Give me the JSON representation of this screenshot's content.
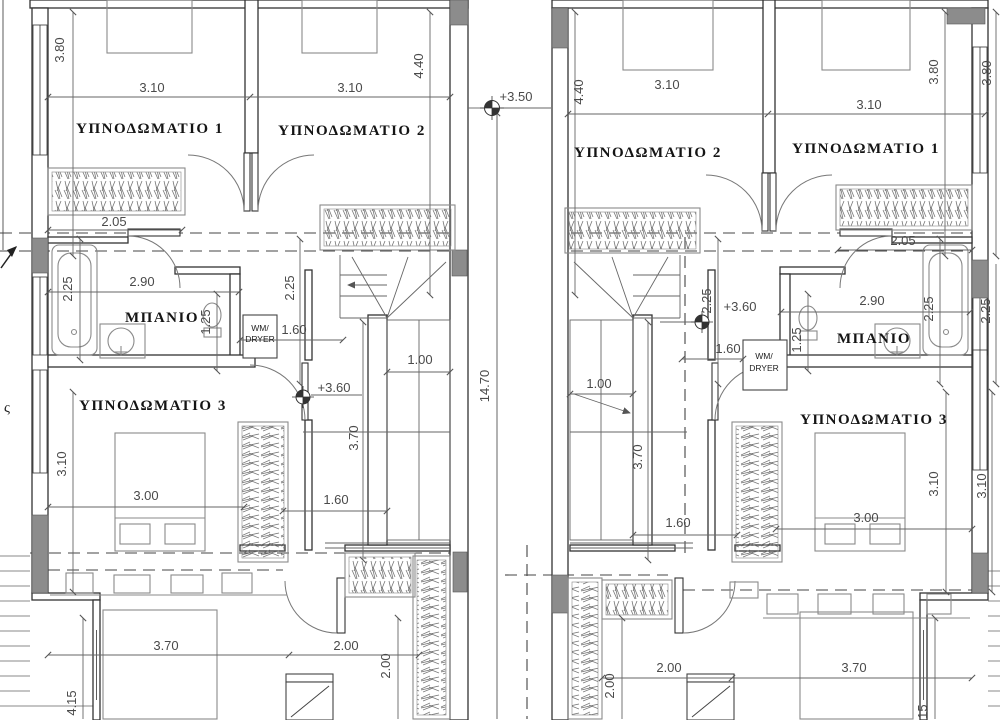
{
  "rooms": {
    "l1": "ΥΠΝΟΔΩΜΑΤΙΟ 1",
    "l2": "ΥΠΝΟΔΩΜΑΤΙΟ 2",
    "l3": "ΥΠΝΟΔΩΜΑΤΙΟ 3",
    "lbath": "ΜΠΑΝΙΟ",
    "r1": "ΥΠΝΟΔΩΜΑΤΙΟ 1",
    "r2": "ΥΠΝΟΔΩΜΑΤΙΟ 2",
    "r3": "ΥΠΝΟΔΩΜΑΤΙΟ 3",
    "rbath": "ΜΠΑΝΙΟ"
  },
  "levels": {
    "upper": "+3.50",
    "left_floor": "+3.60",
    "right_floor": "+3.60"
  },
  "appliances": {
    "lwm_line1": "WM/",
    "lwm_line2": "DRYER",
    "rwm_line1": "WM/",
    "rwm_line2": "DRYER"
  },
  "dims": {
    "l380": "3.80",
    "l310a": "3.10",
    "l310b": "3.10",
    "l440": "4.40",
    "l205": "2.05",
    "l225a": "2.25",
    "l290": "2.90",
    "l125": "1.25",
    "l160a": "1.60",
    "l225b": "2.25",
    "l310c": "3.10",
    "l300": "3.00",
    "l160b": "1.60",
    "l370a": "3.70",
    "l100": "1.00",
    "l370b": "3.70",
    "l200a": "2.00",
    "l200b": "2.00",
    "l415": "4.15",
    "total": "14.70",
    "r440": "4.40",
    "r310a": "3.10",
    "r310b": "3.10",
    "r380a": "3.80",
    "r380b": "3.80",
    "r205": "2.05",
    "r225a": "2.25",
    "r160a": "1.60",
    "r125": "1.25",
    "r290": "2.90",
    "r225b": "2.25",
    "r225c": "2.25",
    "r100": "1.00",
    "r370a": "3.70",
    "r160b": "1.60",
    "r300": "3.00",
    "r310c": "3.10",
    "r310d": "3.10",
    "r200a": "2.00",
    "r200b": "2.00",
    "r370b": "3.70",
    "r415": "4.15"
  },
  "misc": {
    "edge_letter": "ς"
  },
  "colors": {
    "wall": "#333333",
    "poche": "#8c8c8c",
    "dimension": "#555555",
    "furniture": "#8a8a8a",
    "dashed": "#444444"
  }
}
